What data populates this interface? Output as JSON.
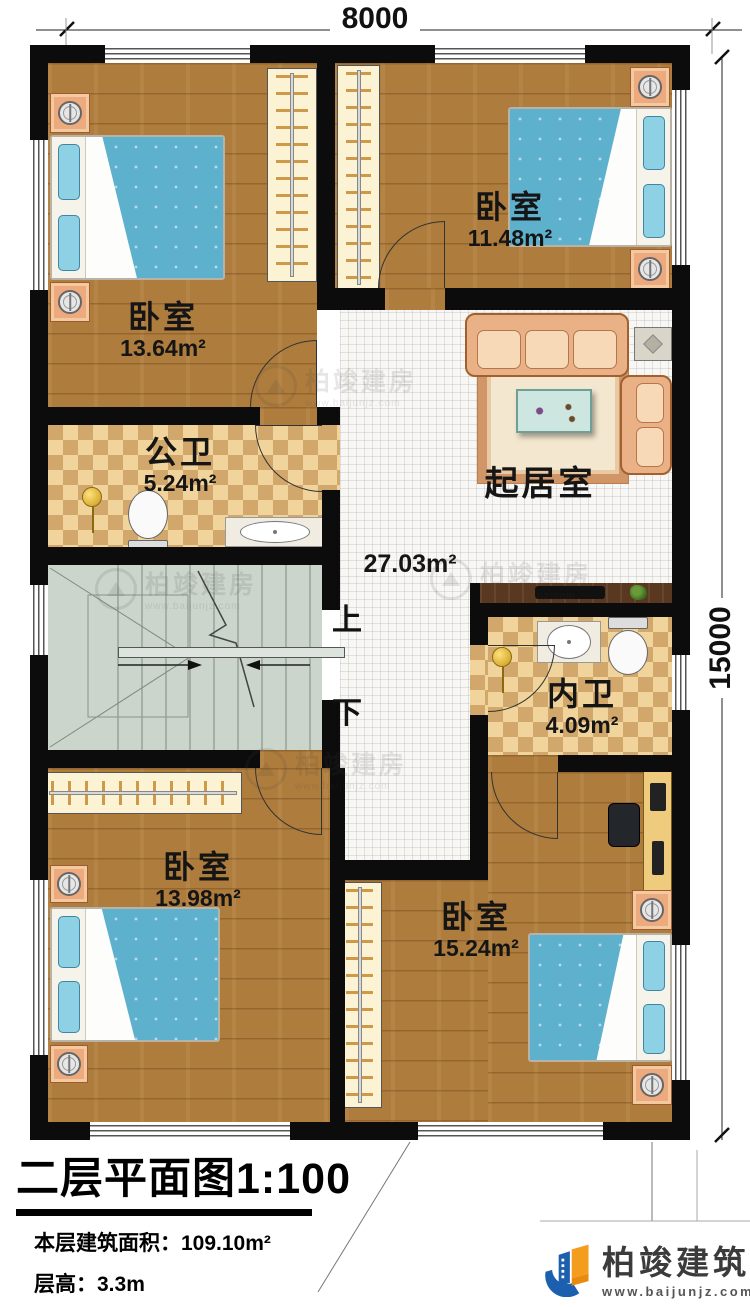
{
  "dimensions": {
    "width_label": "8000",
    "height_label": "15000"
  },
  "rooms": [
    {
      "name": "卧室",
      "area": "13.64m²"
    },
    {
      "name": "卧室",
      "area": "11.48m²"
    },
    {
      "name": "公卫",
      "area": "5.24m²"
    },
    {
      "name": "起居室",
      "area": "27.03m²"
    },
    {
      "name": "内卫",
      "area": "4.09m²"
    },
    {
      "name": "卧室",
      "area": "13.98m²"
    },
    {
      "name": "卧室",
      "area": "15.24m²"
    }
  ],
  "stairs": {
    "up_label": "上",
    "down_label": "下"
  },
  "title_block": {
    "title": "二层平面图",
    "scale": "1:100",
    "floor_area_label": "本层建筑面积：",
    "floor_area_value": "109.10m²",
    "floor_height_label": "层高：",
    "floor_height_value": "3.3m"
  },
  "brand": {
    "name": "柏竣建筑",
    "website": "www.baijunjz.com"
  },
  "watermark": {
    "name": "柏竣建房",
    "website": "www.baijunjz.com"
  },
  "colors": {
    "wall": "#0c0c0c",
    "wood_floor": "#ae7c3c",
    "tile_floor": "#f8f7f4",
    "checker_light": "#f0d49c",
    "checker_dark": "#d2a76b",
    "stair_floor": "#cbd5cb",
    "bed_blue": "#5db1cd",
    "sofa_tan": "#e9b185",
    "brand_blue": "#1c5fae",
    "brand_orange": "#f49c1e"
  }
}
